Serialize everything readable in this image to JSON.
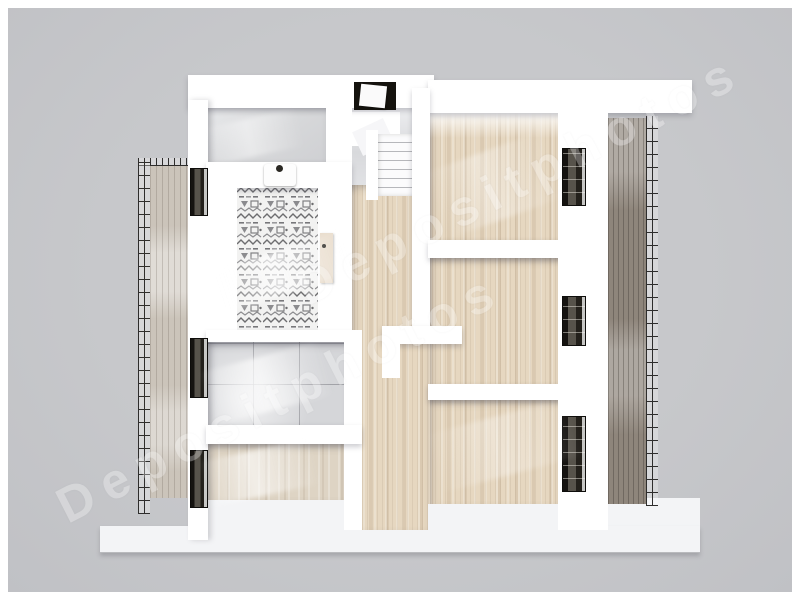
{
  "scene": {
    "description": "3D top-down render of an apartment floor plan with balconies",
    "background_color": "#c7c8cb",
    "frame_color": "#ffffff",
    "wall_color": "#ffffff",
    "wood_floor_color": "#e6d7c0",
    "pale_wood_floor_color": "#ded4c4",
    "gray_tile_color": "#d5d6d9",
    "concrete_floor_color": "#d7d8da",
    "stair_hall_color": "#e0e1e4",
    "deck_left_color": "#cbc4ba",
    "deck_right_color": "#8e857b",
    "railing_color": "#2e2d2c",
    "window_frame_color": "#1b1916",
    "slab_color": "#f3f4f6",
    "door_leaf_color": "#e9ddcd"
  },
  "watermark": {
    "text": "Depositphotos",
    "color": "#ffffff",
    "opacity": 0.3
  }
}
